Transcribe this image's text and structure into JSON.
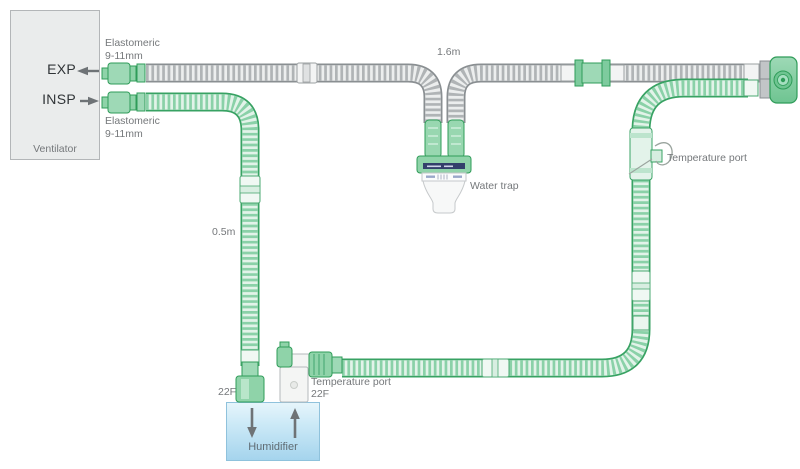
{
  "ventilator": {
    "label": "Ventilator",
    "exp_label": "EXP",
    "insp_label": "INSP",
    "exp_port_line1": "Elastomeric",
    "exp_port_line2": "9-11mm",
    "insp_port_line1": "Elastomeric",
    "insp_port_line2": "9-11mm"
  },
  "tubes": {
    "expiratory_length": "1.6m",
    "inspiratory_length": "0.5m"
  },
  "water_trap": {
    "label": "Water trap"
  },
  "temperature_ports": {
    "right_label": "Temperature port",
    "humidifier_label": "Temperature port"
  },
  "humidifier": {
    "label": "Humidifier",
    "inlet_size": "22F",
    "outlet_size": "22F"
  },
  "colors": {
    "tube_green": "#38a263",
    "tube_green_light": "#8ad1a8",
    "tube_gray": "#8a8f92",
    "tube_gray_light": "#b0b4b6",
    "humidifier_blue": "#a5d4ed",
    "label_gray": "#75787b",
    "trap_band_navy": "#33406b"
  }
}
